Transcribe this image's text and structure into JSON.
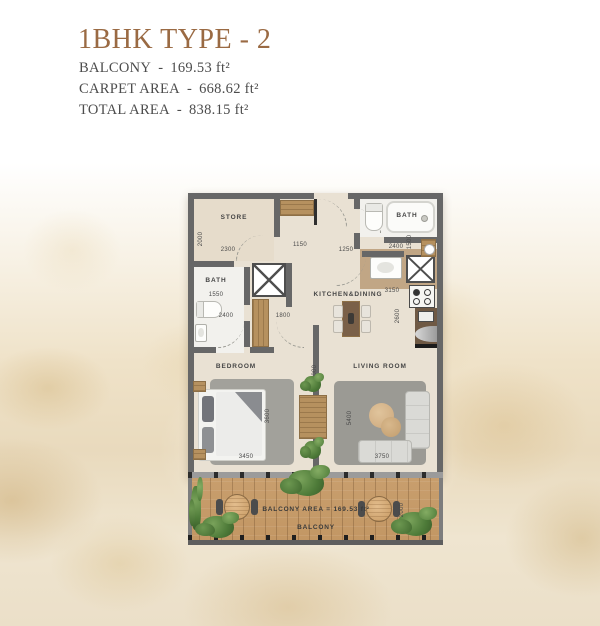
{
  "header": {
    "title": "1BHK TYPE - 2",
    "areas": [
      {
        "label": "BALCONY",
        "sep": "-",
        "value": "169.53 ft²"
      },
      {
        "label": "CARPET AREA",
        "sep": "-",
        "value": "668.62 ft²"
      },
      {
        "label": "TOTAL AREA",
        "sep": "-",
        "value": "838.15 ft²"
      }
    ]
  },
  "plan": {
    "rooms": {
      "store": "STORE",
      "bath_right": "BATH",
      "bath_left": "BATH",
      "kitchen": "KITCHEN&DINING",
      "bedroom": "BEDROOM",
      "living": "LIVING ROOM"
    },
    "dims": {
      "store_h": "2000",
      "store_w": "2300",
      "foyer": "1150",
      "entry": "1250",
      "bath_right_w": "2400",
      "bath_right_h": "1500",
      "bath_left_w": "1550",
      "bath_left_h": "2400",
      "hall": "1800",
      "kitchen_w": "3150",
      "kitchen_h": "2600",
      "bedroom_h": "3600",
      "center_h": "6000",
      "living_h": "5400",
      "bedroom_w": "3450",
      "living_w": "3750",
      "balcony_h": "2000"
    },
    "balcony": {
      "area_text": "BALCONY AREA = 169.53 ft²",
      "label": "BALCONY"
    }
  },
  "colors": {
    "title": "#9a6a43",
    "wall": "#676767",
    "floor": "#e9e1d3",
    "deck": "#c89e6d",
    "plant": "#4d7a38"
  }
}
